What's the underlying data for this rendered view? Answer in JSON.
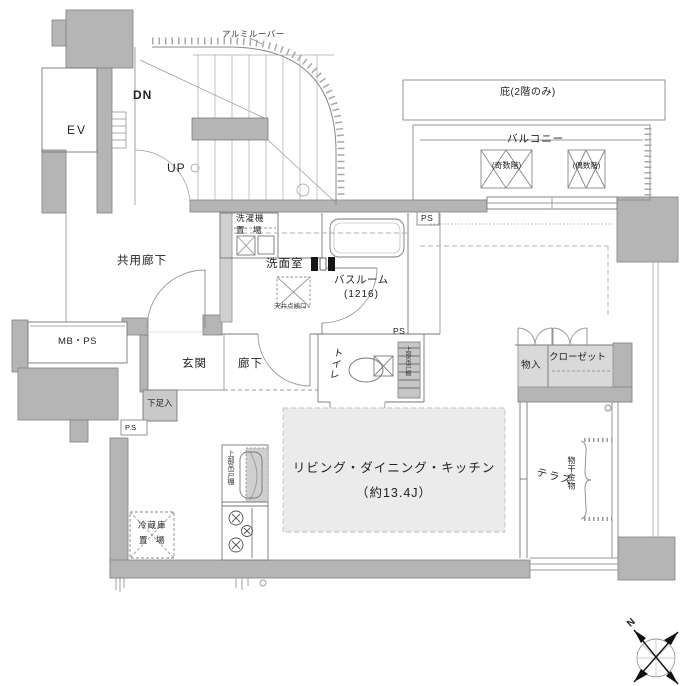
{
  "labels": {
    "ev": "EV",
    "dn": "DN",
    "up": "UP",
    "aluminum_louver": "アルミルーバー",
    "eaves": "庇(2階のみ)",
    "balcony": "バルコニー",
    "odd_floors": "(奇数階)",
    "even_floors": "(偶数階)",
    "washer_l1": "洗濯機",
    "washer_l2": "置 場",
    "washroom": "洗面室",
    "bathroom": "バスルーム",
    "bathroom_size": "(1216)",
    "ceiling_hatch": "天井点検口",
    "ps_top": "PS",
    "ps_mid": "PS",
    "ps_box": "P.S",
    "common_corridor": "共用廊下",
    "mb_ps": "MB・PS",
    "entrance": "玄関",
    "hallway": "廊下",
    "shoe_box": "下足入",
    "toilet": "トイレ",
    "upper_cabinet_toilet": "上部吊戸棚",
    "storage": "物入",
    "closet": "クローゼット",
    "ldk": "リビング・ダイニング・キッチン",
    "ldk_size": "（約13.4J）",
    "terrace": "テラス",
    "drying_fixture": "物干金物",
    "fridge_l1": "冷蔵庫",
    "fridge_l2": "置 場",
    "upper_cabinet_kitchen": "上部吊戸棚",
    "compass_north": "N"
  },
  "colors": {
    "wall": "#b5b5b5",
    "wall_light": "#d4d4d4",
    "floor_shade": "#ebebeb",
    "line": "#777777",
    "text": "#222222"
  }
}
